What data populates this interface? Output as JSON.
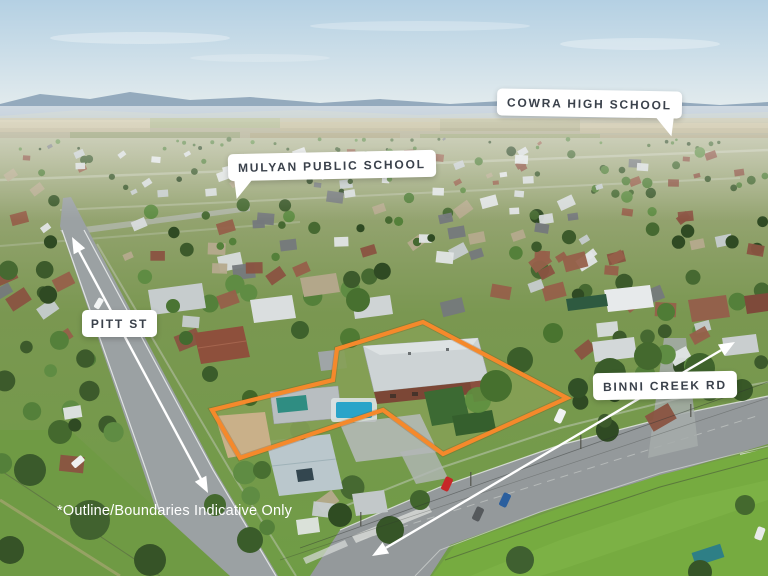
{
  "labels": {
    "cowra": {
      "text": "COWRA HIGH SCHOOL"
    },
    "mulyan": {
      "text": "MULYAN PUBLIC SCHOOL"
    },
    "pitt": {
      "text": "PITT ST"
    },
    "binni": {
      "text": "BINNI CREEK RD"
    }
  },
  "disclaimer": {
    "text": "*Outline/Boundaries Indicative Only"
  },
  "colors": {
    "boundary_outline": "#F5892B",
    "label_background": "#FFFFFF",
    "label_text": "#3A414B",
    "arrow": "#FFFFFF",
    "disclaimer_text": "#FFFFFF"
  }
}
